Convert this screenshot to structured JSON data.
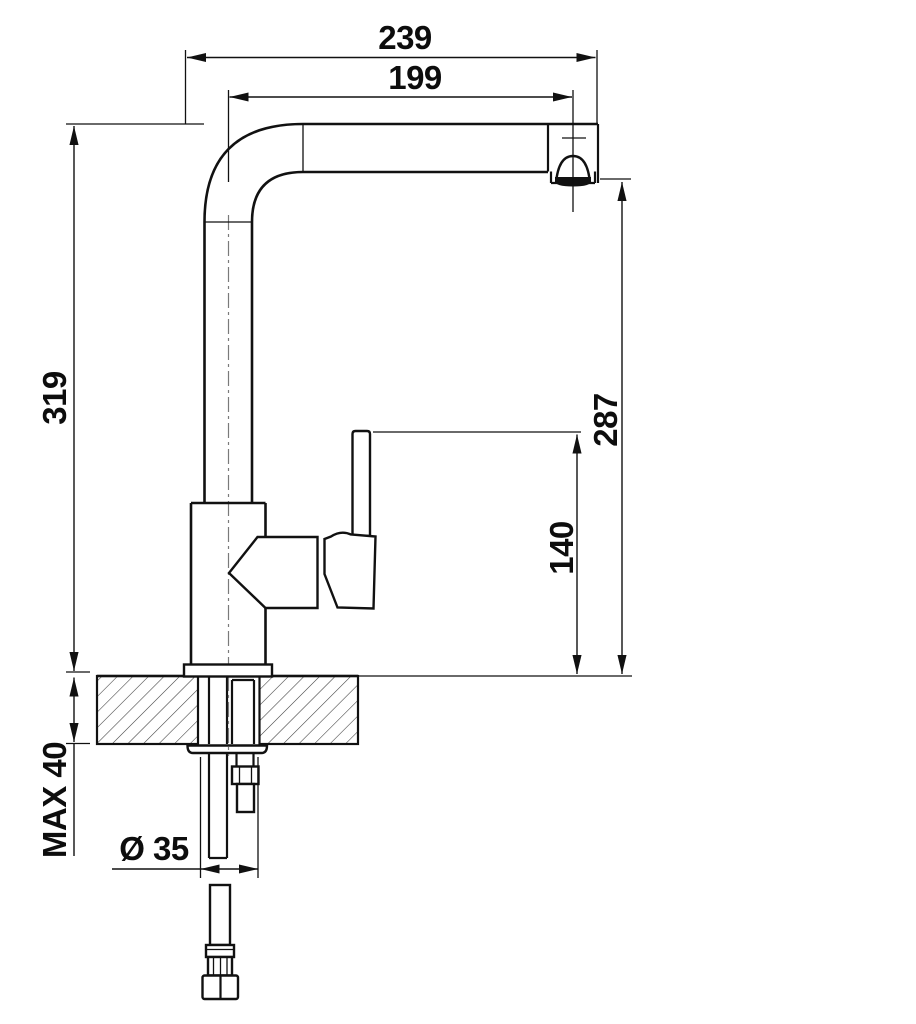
{
  "drawing": {
    "background": "#ffffff",
    "line_color": "#111111",
    "centerline_color": "#7a7a7a",
    "subject": "single-lever kitchen faucet, side elevation with installation dimensions"
  },
  "dimensions": {
    "total_projection": "239",
    "spout_reach": "199",
    "total_height": "319",
    "outlet_height": "287",
    "handle_height": "140",
    "max_deck_thickness": "MAX 40",
    "hole_diameter": "Ø 35"
  }
}
